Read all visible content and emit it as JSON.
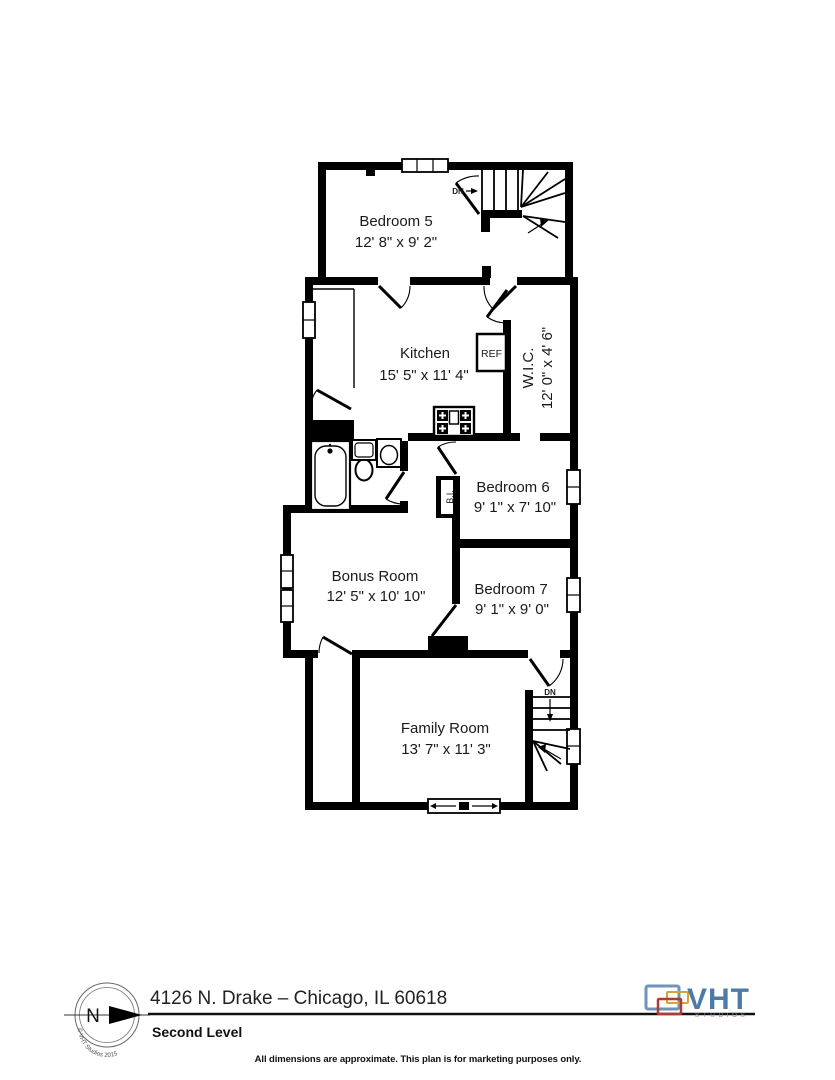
{
  "rooms": {
    "bedroom5": {
      "name": "Bedroom 5",
      "dims": "12' 8\" x 9' 2\""
    },
    "kitchen": {
      "name": "Kitchen",
      "dims": "15' 5\" x 11' 4\""
    },
    "wic": {
      "name": "W.I.C.",
      "dims": "12' 0\" x 4' 6\""
    },
    "bedroom6": {
      "name": "Bedroom 6",
      "dims": "9' 1\" x 7' 10\""
    },
    "bonus_room": {
      "name": "Bonus Room",
      "dims": "12' 5\" x 10' 10\""
    },
    "bedroom7": {
      "name": "Bedroom 7",
      "dims": "9' 1\" x 9' 0\""
    },
    "family_room": {
      "name": "Family Room",
      "dims": "13' 7\" x 11' 3\""
    }
  },
  "annotations": {
    "refrigerator": "REF",
    "built_in": "B.I.",
    "down": "DN"
  },
  "footer": {
    "address": "4126 N. Drake – Chicago, IL 60618",
    "level": "Second Level",
    "disclaimer": "All dimensions are approximate. This plan is for marketing purposes only."
  },
  "compass": {
    "north": "N",
    "copyright": "© VHT Studios 2015"
  },
  "logo": {
    "name": "VHT",
    "sub": "STUDIOS"
  },
  "colors": {
    "wall": "#000000",
    "text": "#1a1a1a",
    "logo_blue": "#4c7ca6",
    "logo_orange": "#d9a13b",
    "logo_red": "#b23b30"
  }
}
